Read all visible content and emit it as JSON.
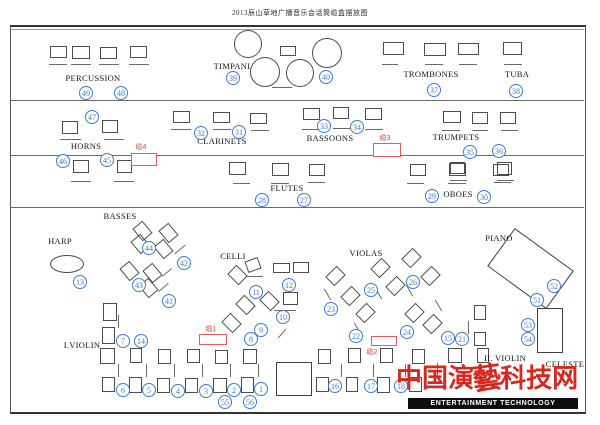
{
  "title": "2013辰山草地广播音乐会话筒缆盒摆放图",
  "colors": {
    "mic_circle_blue": "#3a7bd5",
    "cable_red": "#e06060",
    "cable_text_red": "#d84040",
    "logo_red": "#d5281e",
    "line_gray": "#6b6b6b"
  },
  "logo": {
    "cn": "中国演藝科技网",
    "en": "ENTERTAINMENT TECHNOLOGY"
  },
  "section_labels": [
    {
      "text": "PERCUSSION",
      "x": 93,
      "y": 78
    },
    {
      "text": "TIMPANI",
      "x": 232,
      "y": 66
    },
    {
      "text": "TROMBONES",
      "x": 431,
      "y": 74
    },
    {
      "text": "TUBA",
      "x": 517,
      "y": 74
    },
    {
      "text": "HORNS",
      "x": 86,
      "y": 146
    },
    {
      "text": "CLARINETS",
      "x": 222,
      "y": 141
    },
    {
      "text": "BASSOONS",
      "x": 330,
      "y": 138
    },
    {
      "text": "TRUMPETS",
      "x": 456,
      "y": 137
    },
    {
      "text": "FLUTES",
      "x": 287,
      "y": 188
    },
    {
      "text": "OBOES",
      "x": 458,
      "y": 194
    },
    {
      "text": "BASSES",
      "x": 120,
      "y": 216
    },
    {
      "text": "HARP",
      "x": 60,
      "y": 241
    },
    {
      "text": "CELLI",
      "x": 233,
      "y": 256
    },
    {
      "text": "VIOLAS",
      "x": 366,
      "y": 253
    },
    {
      "text": "PIANO",
      "x": 499,
      "y": 238
    },
    {
      "text": "I.VIOLIN",
      "x": 82,
      "y": 345
    },
    {
      "text": "II. VIOLIN",
      "x": 505,
      "y": 358
    },
    {
      "text": "CELESTE",
      "x": 565,
      "y": 364
    }
  ],
  "mic_positions": [
    {
      "n": "49",
      "x": 86,
      "y": 93
    },
    {
      "n": "48",
      "x": 121,
      "y": 93
    },
    {
      "n": "39",
      "x": 233,
      "y": 78
    },
    {
      "n": "40",
      "x": 326,
      "y": 77
    },
    {
      "n": "37",
      "x": 434,
      "y": 90
    },
    {
      "n": "38",
      "x": 516,
      "y": 91
    },
    {
      "n": "47",
      "x": 92,
      "y": 117
    },
    {
      "n": "46",
      "x": 63,
      "y": 161
    },
    {
      "n": "45",
      "x": 107,
      "y": 160
    },
    {
      "n": "32",
      "x": 201,
      "y": 133
    },
    {
      "n": "31",
      "x": 239,
      "y": 132
    },
    {
      "n": "33",
      "x": 324,
      "y": 126
    },
    {
      "n": "34",
      "x": 357,
      "y": 127
    },
    {
      "n": "35",
      "x": 470,
      "y": 152
    },
    {
      "n": "36",
      "x": 499,
      "y": 151
    },
    {
      "n": "28",
      "x": 262,
      "y": 200
    },
    {
      "n": "27",
      "x": 304,
      "y": 200
    },
    {
      "n": "29",
      "x": 432,
      "y": 196
    },
    {
      "n": "30",
      "x": 484,
      "y": 197
    },
    {
      "n": "13",
      "x": 80,
      "y": 282
    },
    {
      "n": "44",
      "x": 149,
      "y": 248
    },
    {
      "n": "42",
      "x": 184,
      "y": 263
    },
    {
      "n": "43",
      "x": 139,
      "y": 285
    },
    {
      "n": "41",
      "x": 169,
      "y": 301
    },
    {
      "n": "11",
      "x": 256,
      "y": 292
    },
    {
      "n": "12",
      "x": 289,
      "y": 285
    },
    {
      "n": "10",
      "x": 283,
      "y": 317
    },
    {
      "n": "9",
      "x": 261,
      "y": 330
    },
    {
      "n": "8",
      "x": 251,
      "y": 339
    },
    {
      "n": "25",
      "x": 371,
      "y": 290
    },
    {
      "n": "26",
      "x": 413,
      "y": 282
    },
    {
      "n": "23",
      "x": 331,
      "y": 309
    },
    {
      "n": "22",
      "x": 356,
      "y": 336
    },
    {
      "n": "24",
      "x": 407,
      "y": 332
    },
    {
      "n": "15",
      "x": 448,
      "y": 338
    },
    {
      "n": "21",
      "x": 462,
      "y": 339
    },
    {
      "n": "52",
      "x": 554,
      "y": 286
    },
    {
      "n": "51",
      "x": 537,
      "y": 300
    },
    {
      "n": "53",
      "x": 528,
      "y": 325
    },
    {
      "n": "54",
      "x": 528,
      "y": 339
    },
    {
      "n": "7",
      "x": 123,
      "y": 341
    },
    {
      "n": "14",
      "x": 141,
      "y": 341
    },
    {
      "n": "6",
      "x": 123,
      "y": 390
    },
    {
      "n": "5",
      "x": 149,
      "y": 390
    },
    {
      "n": "4",
      "x": 178,
      "y": 391
    },
    {
      "n": "3",
      "x": 206,
      "y": 391
    },
    {
      "n": "2",
      "x": 234,
      "y": 390
    },
    {
      "n": "1",
      "x": 261,
      "y": 389
    },
    {
      "n": "55",
      "x": 225,
      "y": 402
    },
    {
      "n": "56",
      "x": 250,
      "y": 402
    },
    {
      "n": "16",
      "x": 335,
      "y": 386
    },
    {
      "n": "17",
      "x": 371,
      "y": 386
    },
    {
      "n": "18",
      "x": 401,
      "y": 386
    }
  ],
  "cable_boxes": [
    {
      "label": "缆4",
      "lx": 141,
      "ly": 147,
      "x": 131,
      "y": 153,
      "w": 26,
      "h": 13
    },
    {
      "label": "缆3",
      "lx": 385,
      "ly": 138,
      "x": 373,
      "y": 143,
      "w": 28,
      "h": 14
    },
    {
      "label": "缆1",
      "lx": 211,
      "ly": 329,
      "x": 199,
      "y": 334,
      "w": 28,
      "h": 11
    },
    {
      "label": "缆2",
      "lx": 372,
      "ly": 352,
      "x": 371,
      "y": 336,
      "w": 26,
      "h": 10
    }
  ],
  "frame": {
    "left": 10,
    "top": 25,
    "right": 584,
    "bottom": 410,
    "inner_lines_y": [
      100,
      155,
      207
    ]
  },
  "furniture": {
    "chairs": [
      [
        50,
        46,
        17,
        12,
        0
      ],
      [
        72,
        46,
        18,
        13,
        0
      ],
      [
        100,
        47,
        17,
        12,
        0
      ],
      [
        130,
        46,
        17,
        12,
        0
      ],
      [
        280,
        46,
        16,
        10,
        0
      ],
      [
        383,
        42,
        21,
        13,
        0
      ],
      [
        424,
        43,
        22,
        13,
        0
      ],
      [
        458,
        43,
        21,
        12,
        0
      ],
      [
        503,
        42,
        19,
        13,
        0
      ],
      [
        62,
        121,
        16,
        13,
        0
      ],
      [
        102,
        120,
        16,
        13,
        0
      ],
      [
        73,
        160,
        16,
        13,
        0
      ],
      [
        117,
        160,
        15,
        13,
        0
      ],
      [
        173,
        111,
        17,
        12,
        0
      ],
      [
        213,
        112,
        17,
        11,
        0
      ],
      [
        250,
        113,
        17,
        11,
        0
      ],
      [
        303,
        108,
        17,
        12,
        0
      ],
      [
        333,
        107,
        16,
        12,
        0
      ],
      [
        365,
        108,
        17,
        12,
        0
      ],
      [
        443,
        111,
        18,
        12,
        0
      ],
      [
        472,
        112,
        16,
        12,
        0
      ],
      [
        500,
        112,
        16,
        12,
        0
      ],
      [
        450,
        162,
        15,
        12,
        0
      ],
      [
        497,
        162,
        15,
        13,
        0
      ],
      [
        229,
        162,
        17,
        13,
        0
      ],
      [
        272,
        163,
        17,
        13,
        0
      ],
      [
        309,
        164,
        16,
        12,
        0
      ],
      [
        410,
        164,
        16,
        12,
        0
      ],
      [
        449,
        163,
        17,
        13,
        0
      ],
      [
        493,
        164,
        16,
        12,
        0
      ],
      [
        136,
        223,
        13,
        16,
        -40
      ],
      [
        162,
        225,
        13,
        16,
        -40
      ],
      [
        134,
        236,
        13,
        16,
        -40
      ],
      [
        157,
        241,
        13,
        16,
        -40
      ],
      [
        123,
        263,
        13,
        16,
        -40
      ],
      [
        146,
        265,
        13,
        16,
        -40
      ],
      [
        142,
        280,
        13,
        16,
        -40
      ],
      [
        103,
        303,
        14,
        18,
        0
      ],
      [
        102,
        327,
        13,
        17,
        0
      ],
      [
        231,
        267,
        13,
        16,
        -45
      ],
      [
        246,
        259,
        14,
        12,
        -20
      ],
      [
        273,
        263,
        17,
        10,
        0
      ],
      [
        293,
        262,
        16,
        11,
        0
      ],
      [
        263,
        293,
        13,
        16,
        -45
      ],
      [
        283,
        292,
        15,
        13,
        0
      ],
      [
        239,
        297,
        13,
        16,
        -45
      ],
      [
        225,
        315,
        13,
        16,
        -45
      ],
      [
        329,
        268,
        13,
        16,
        45
      ],
      [
        344,
        288,
        13,
        16,
        45
      ],
      [
        359,
        305,
        13,
        16,
        45
      ],
      [
        374,
        260,
        13,
        16,
        45
      ],
      [
        389,
        278,
        13,
        16,
        45
      ],
      [
        405,
        250,
        13,
        16,
        45
      ],
      [
        408,
        305,
        13,
        16,
        45
      ],
      [
        424,
        268,
        13,
        16,
        45
      ],
      [
        426,
        316,
        13,
        16,
        45
      ],
      [
        100,
        348,
        15,
        16,
        0
      ],
      [
        130,
        348,
        12,
        15,
        0
      ],
      [
        158,
        349,
        13,
        15,
        0
      ],
      [
        187,
        349,
        13,
        14,
        0
      ],
      [
        215,
        350,
        13,
        14,
        0
      ],
      [
        243,
        349,
        14,
        15,
        0
      ],
      [
        102,
        377,
        13,
        15,
        0
      ],
      [
        129,
        377,
        13,
        16,
        0
      ],
      [
        157,
        378,
        13,
        15,
        0
      ],
      [
        185,
        378,
        13,
        15,
        0
      ],
      [
        213,
        378,
        14,
        15,
        0
      ],
      [
        241,
        377,
        13,
        16,
        0
      ],
      [
        318,
        349,
        13,
        15,
        0
      ],
      [
        348,
        348,
        13,
        15,
        0
      ],
      [
        380,
        348,
        13,
        15,
        0
      ],
      [
        412,
        349,
        13,
        15,
        0
      ],
      [
        448,
        348,
        14,
        15,
        0
      ],
      [
        316,
        377,
        13,
        15,
        0
      ],
      [
        346,
        377,
        12,
        15,
        0
      ],
      [
        377,
        377,
        13,
        16,
        0
      ],
      [
        409,
        377,
        13,
        15,
        0
      ],
      [
        474,
        305,
        12,
        15,
        0
      ],
      [
        474,
        332,
        12,
        14,
        0
      ],
      [
        477,
        348,
        12,
        15,
        0
      ]
    ],
    "stands": [
      [
        58,
        64,
        18,
        0
      ],
      [
        81,
        64,
        20,
        0
      ],
      [
        109,
        64,
        20,
        0
      ],
      [
        139,
        64,
        20,
        0
      ],
      [
        282,
        87,
        20,
        0
      ],
      [
        390,
        64,
        16,
        0
      ],
      [
        434,
        64,
        18,
        0
      ],
      [
        468,
        64,
        18,
        0
      ],
      [
        513,
        64,
        18,
        0
      ],
      [
        70,
        139,
        21,
        0
      ],
      [
        114,
        139,
        20,
        0
      ],
      [
        81,
        181,
        20,
        0
      ],
      [
        124,
        181,
        20,
        0
      ],
      [
        181,
        129,
        20,
        0
      ],
      [
        222,
        129,
        18,
        0
      ],
      [
        260,
        130,
        18,
        0
      ],
      [
        311,
        129,
        18,
        0
      ],
      [
        342,
        128,
        18,
        0
      ],
      [
        374,
        129,
        18,
        0
      ],
      [
        451,
        130,
        18,
        0
      ],
      [
        480,
        130,
        16,
        0
      ],
      [
        509,
        130,
        17,
        0
      ],
      [
        458,
        180,
        17,
        0
      ],
      [
        505,
        180,
        17,
        0
      ],
      [
        241,
        183,
        17,
        0
      ],
      [
        280,
        183,
        18,
        0
      ],
      [
        316,
        182,
        17,
        0
      ],
      [
        415,
        183,
        17,
        0
      ],
      [
        457,
        183,
        18,
        0
      ],
      [
        502,
        182,
        17,
        0
      ],
      [
        180,
        249,
        14,
        -40
      ],
      [
        167,
        272,
        12,
        -40
      ],
      [
        163,
        287,
        13,
        -40
      ],
      [
        255,
        276,
        16,
        0
      ],
      [
        285,
        310,
        22,
        0
      ],
      [
        282,
        333,
        12,
        -50
      ],
      [
        327,
        294,
        13,
        60
      ],
      [
        378,
        293,
        13,
        60
      ],
      [
        357,
        328,
        13,
        60
      ],
      [
        409,
        290,
        13,
        60
      ],
      [
        438,
        305,
        13,
        60
      ],
      [
        118,
        321,
        13,
        90
      ],
      [
        118,
        370,
        13,
        90
      ],
      [
        146,
        370,
        13,
        90
      ],
      [
        174,
        370,
        13,
        90
      ],
      [
        202,
        370,
        13,
        90
      ],
      [
        230,
        370,
        13,
        90
      ],
      [
        258,
        370,
        13,
        90
      ],
      [
        341,
        370,
        13,
        90
      ],
      [
        373,
        370,
        13,
        90
      ],
      [
        405,
        370,
        13,
        90
      ],
      [
        437,
        369,
        13,
        90
      ],
      [
        468,
        327,
        13,
        90
      ]
    ],
    "timpani_circles": [
      [
        248,
        44,
        14
      ],
      [
        265,
        72,
        15
      ],
      [
        300,
        73,
        14
      ],
      [
        327,
        53,
        15
      ]
    ],
    "harp": {
      "cx": 67,
      "cy": 264,
      "rx": 17,
      "ry": 9
    },
    "piano": {
      "cx": 530,
      "cy": 268,
      "w": 73,
      "h": 47,
      "r": 36
    },
    "celeste": {
      "x": 537,
      "y": 308,
      "w": 26,
      "h": 45
    },
    "podium": {
      "x": 276,
      "y": 362,
      "w": 36,
      "h": 34
    }
  }
}
